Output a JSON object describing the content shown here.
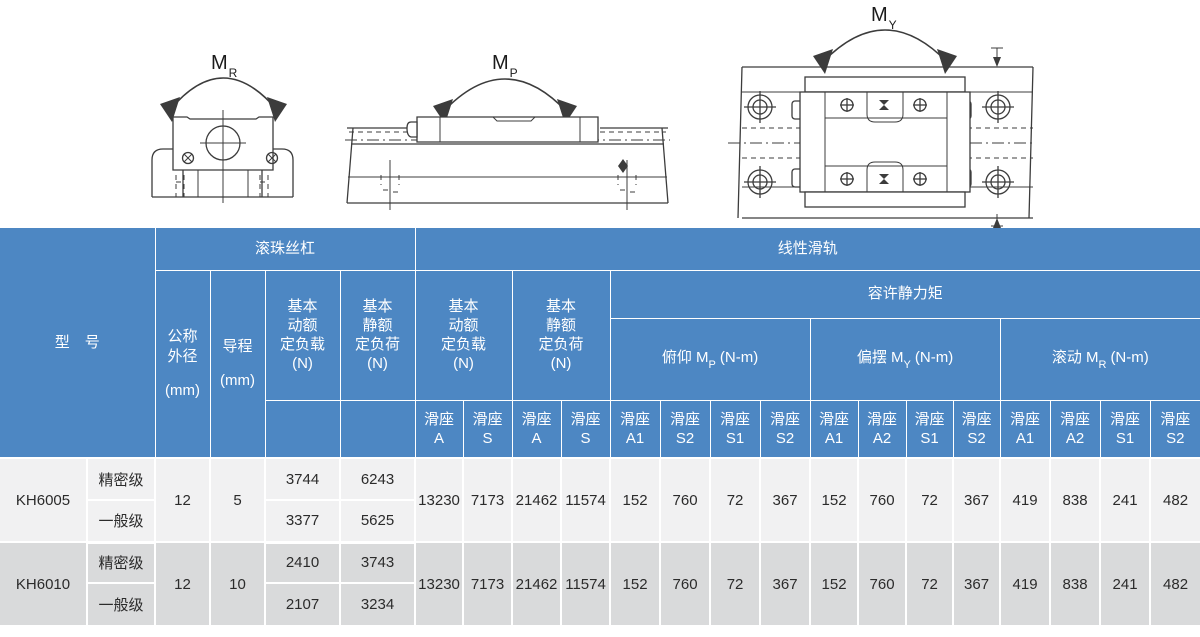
{
  "colors": {
    "header_blue": "#4d87c3",
    "row_light": "#f1f1f2",
    "row_dark": "#d9dadb",
    "grid_white": "#ffffff",
    "line_art": "#3c3c3c",
    "header_text": "#ffffff",
    "body_text": "#2b2b2b"
  },
  "diagrams": {
    "roll": {
      "m": "M",
      "sub": "R"
    },
    "pitch": {
      "m": "M",
      "sub": "P"
    },
    "yaw": {
      "m": "M",
      "sub": "Y"
    }
  },
  "table": {
    "header": {
      "model": "型　号",
      "ball_screw": "滚珠丝杠",
      "linear_guide": "线性滑轨",
      "nominal_od": [
        "公称",
        "外径",
        "(mm)"
      ],
      "lead": [
        "导程",
        "(mm)"
      ],
      "bs_dyn": [
        "基本",
        "动额",
        "定负载",
        "(N)"
      ],
      "bs_stat": [
        "基本",
        "静额",
        "定负荷",
        "(N)"
      ],
      "lg_dyn": [
        "基本",
        "动额",
        "定负载",
        "(N)"
      ],
      "lg_stat": [
        "基本",
        "静额",
        "定负荷",
        "(N)"
      ],
      "allow": "容许静力矩",
      "mp": {
        "pre": "俯仰 M",
        "sub": "P",
        "post": "(N-m)"
      },
      "my": {
        "pre": "偏摆 M",
        "sub": "Y",
        "post": "(N-m)"
      },
      "mr": {
        "pre": "滚动 M",
        "sub": "R",
        "post": "(N-m)"
      },
      "seat": "滑座",
      "lg_dyn_cols": [
        "A",
        "S"
      ],
      "lg_stat_cols": [
        "A",
        "S"
      ],
      "mp_cols": [
        "A1",
        "S2",
        "S1",
        "S2"
      ],
      "my_cols": [
        "A1",
        "A2",
        "S1",
        "S2"
      ],
      "mr_cols": [
        "A1",
        "A2",
        "S1",
        "S2"
      ]
    },
    "rows": [
      {
        "model": "KH6005",
        "od": "12",
        "lead": "5",
        "grades": [
          {
            "name": "精密级",
            "bs_dyn": "3744",
            "bs_stat": "6243"
          },
          {
            "name": "一般级",
            "bs_dyn": "3377",
            "bs_stat": "5625"
          }
        ],
        "lg": [
          "13230",
          "7173",
          "21462",
          "11574",
          "152",
          "760",
          "72",
          "367",
          "152",
          "760",
          "72",
          "367",
          "419",
          "838",
          "241",
          "482"
        ]
      },
      {
        "model": "KH6010",
        "od": "12",
        "lead": "10",
        "grades": [
          {
            "name": "精密级",
            "bs_dyn": "2410",
            "bs_stat": "3743"
          },
          {
            "name": "一般级",
            "bs_dyn": "2107",
            "bs_stat": "3234"
          }
        ],
        "lg": [
          "13230",
          "7173",
          "21462",
          "11574",
          "152",
          "760",
          "72",
          "367",
          "152",
          "760",
          "72",
          "367",
          "419",
          "838",
          "241",
          "482"
        ]
      }
    ]
  }
}
